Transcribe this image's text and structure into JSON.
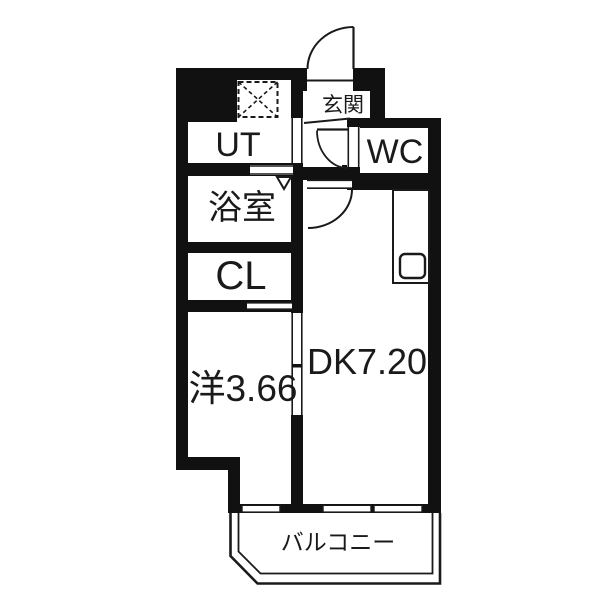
{
  "floorplan": {
    "colors": {
      "wall": "#111111",
      "line": "#1a1a1a",
      "floor": "#ffffff"
    },
    "rooms": {
      "genkan": {
        "label": "玄関"
      },
      "ut": {
        "label": "UT"
      },
      "wc": {
        "label": "WC"
      },
      "bathroom": {
        "label": "浴室"
      },
      "closet": {
        "label": "CL"
      },
      "dk": {
        "label": "DK7.20"
      },
      "western_room": {
        "label": "洋3.66"
      },
      "balcony": {
        "label": "バルコニー"
      }
    }
  }
}
